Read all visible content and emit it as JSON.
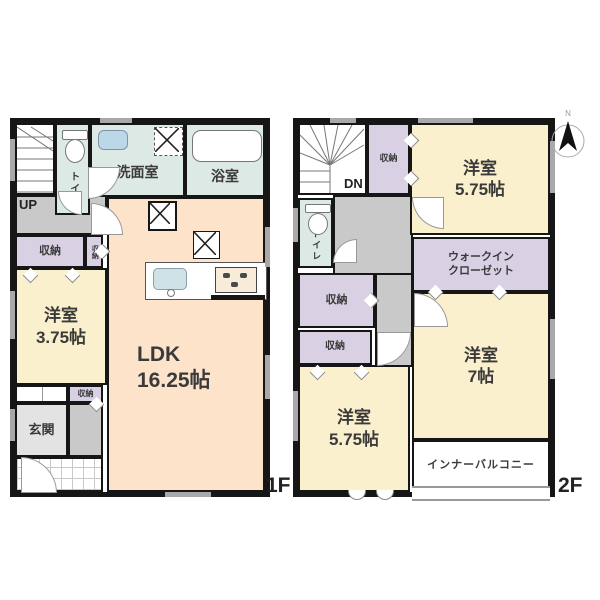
{
  "compass": {
    "north": "N"
  },
  "floor1": {
    "label": "1F",
    "stairs": "UP",
    "toilet": "トイレ",
    "washroom": "洗面室",
    "bathroom": "浴室",
    "storage_main": "収納",
    "storage_narrow": "収納",
    "storage_entry": "収納",
    "bedroom_name": "洋室",
    "bedroom_size": "3.75帖",
    "ldk_name": "LDK",
    "ldk_size": "16.25帖",
    "entrance": "玄関"
  },
  "floor2": {
    "label": "2F",
    "stairs": "DN",
    "toilet": "トイレ",
    "storage_top": "収納",
    "storage_mid": "収納",
    "storage_low": "収納",
    "bedroom_top_name": "洋室",
    "bedroom_top_size": "5.75帖",
    "wic_line1": "ウォークイン",
    "wic_line2": "クローゼット",
    "bedroom_right_name": "洋室",
    "bedroom_right_size": "7帖",
    "bedroom_bottom_name": "洋室",
    "bedroom_bottom_size": "5.75帖",
    "balcony": "インナーバルコニー"
  },
  "colors": {
    "wall": "#161616",
    "room_yellow": "#fbf0cd",
    "ldk_peach": "#fce3ca",
    "closet_purple": "#d9d0e4",
    "wet_area": "#dde9e4",
    "hall_gray": "#c9c9c9",
    "entrance_gray": "#e3e3e3",
    "window_gray": "#a9a9a9"
  }
}
